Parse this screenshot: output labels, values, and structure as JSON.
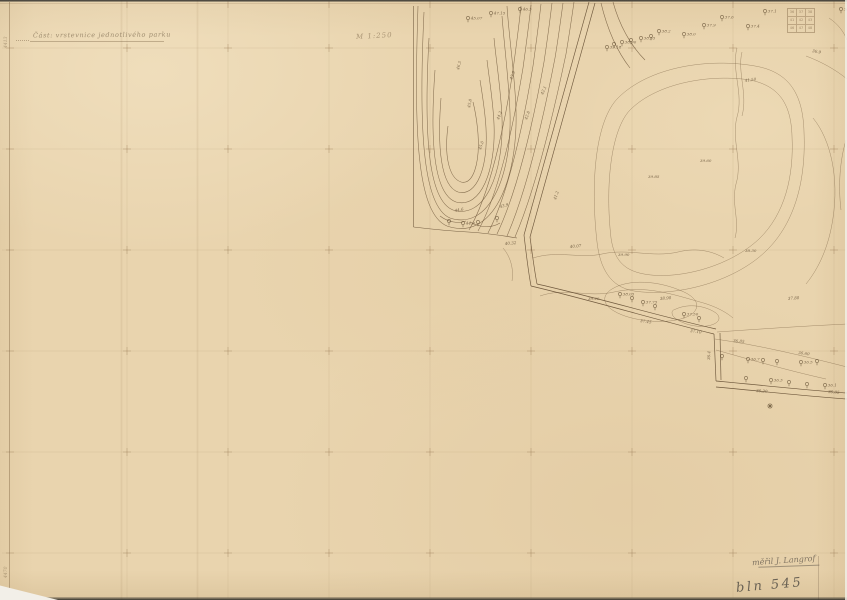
{
  "sheet": {
    "title": "Část: vrstevnice jednotlivého parku",
    "scale_note": "M 1:250",
    "surveyor_signature": "měřil J. Langrof",
    "sheet_number": "bln 545",
    "edge_mark_top": "4413",
    "edge_mark_bottom": "4470"
  },
  "stamp": {
    "rows": [
      [
        "36",
        "37",
        "38"
      ],
      [
        "41",
        "42",
        "43"
      ],
      [
        "46",
        "47",
        "48"
      ]
    ]
  },
  "colors": {
    "paper": "#e9d4ae",
    "ink": "#6c5437",
    "pencil": "#5d564b",
    "grid": "#a58a5f"
  },
  "grid": {
    "vxs": [
      127,
      228,
      329,
      430,
      531,
      632,
      733,
      834
    ],
    "hys": [
      48,
      149,
      250,
      351,
      452,
      553
    ]
  },
  "map": {
    "boundaries": [
      "M413.5,6 L413.5,227",
      "M413.5,227 C430,229 450,231 468,232 C485,233 505,236 517,238"
    ],
    "roads": [
      {
        "a": "M589,2 C566,85 543,165 524,235",
        "b": "M595,3 C572,86 549,167 530,237"
      },
      {
        "a": "M524,235 C526,252 528,270 531,286",
        "b": "M530,237 C532,252 534,268 537,284"
      },
      {
        "a": "M531,286 C590,300 650,318 714,334",
        "b": "M537,284 C595,297 655,315 716,329"
      },
      {
        "a": "M714,334 L716,381",
        "b": "M720,333 L721,380"
      },
      {
        "a": "M716,381 C760,385 805,390 847,393",
        "b": "M716,387 C760,391 805,396 847,399"
      }
    ],
    "contours": [
      "M448,126 C444,156 449,178 461,182 C473,185 480,164 478,134 C477,121 475,110 473,102",
      "M441,98 C437,148 441,186 458,192 C477,197 488,167 486,128 C485,110 482,93 480,80",
      "M435,70 C430,138 433,194 456,202 C481,209 496,170 494,124 C493,100 489,78 487,60",
      "M429,38 C424,128 427,200 453,210 C485,220 504,173 502,118 C501,90 496,60 494,38",
      "M424,12 C419,118 421,206 450,218 C489,231 512,176 510,113 C509,82 504,43 502,16",
      "M418,6 C414,128 416,213 447,226 C493,242 518,180 516,110 C515,76 509,38 507,6",
      "M469,230 C489,196 504,130 513,70 C516,48 519,25 521,6",
      "M478,231 C498,195 513,128 523,68 C526,46 529,24 531,5",
      "M488,233 C508,194 523,126 533,66 C536,44 539,22 541,4",
      "M497,234 C517,192 533,124 544,62 C547,42 550,20 552,3",
      "M507,236 C527,190 543,120 555,58 C558,40 561,18 563,3",
      "M515,237 C536,188 553,116 566,54 C569,36 572,16 574,2",
      "M601,3 C607,28 616,50 630,68",
      "M613,2 C619,24 630,45 645,60",
      "M440,216 C448,222 458,224 466,221",
      "M470,222 C480,228 492,228 500,223"
    ],
    "light": [
      "M597,242 C590,180 596,120 618,98 C650,66 710,58 755,66 C790,72 803,95 804,132 C806,178 796,222 766,251 C732,284 672,297 634,291 C610,287 600,268 597,242 Z",
      "M611,238 C605,185 611,130 630,110 C658,82 712,74 750,80 C780,86 791,105 792,136 C794,176 785,214 759,239 C728,268 676,280 644,274 C622,270 614,258 611,238 Z",
      "M737,48 C731,70 744,94 737,117 C731,140 743,161 736,184 C731,204 740,220 735,238",
      "M742,52 C737,72 748,94 742,116",
      "M533,258 C558,250 580,259 602,254 C628,248 652,258 678,252 C698,247 714,252 724,258",
      "M540,296 C565,287 588,298 614,292 C645,285 672,294 700,302 C715,306 726,312 733,318",
      "M806,56 C822,62 836,70 847,79",
      "M813,118 C831,140 839,178 833,218 C829,246 819,268 806,284",
      "M846,140 C840,160 838,185 841,210",
      "M829,18 C838,24 844,32 847,40",
      "M717,332 C760,329 804,326 847,324",
      "M715,339 C758,345 800,355 847,367",
      "M716,350 C748,359 786,370 826,379",
      "M612,289 C628,279 658,280 684,292 C699,299 701,309 689,316 C668,326 630,321 614,311 C602,304 602,295 612,289 Z",
      "M676,309 C689,303 706,306 716,313 C722,318 719,324 707,326 C693,328 678,322 673,316 C671,312 672,310 676,309 Z",
      "M503,248 C510,256 514,268 512,281"
    ],
    "trees": [
      {
        "x": 468,
        "y": 18,
        "l": "45.07"
      },
      {
        "x": 491,
        "y": 13,
        "l": "47.15"
      },
      {
        "x": 520,
        "y": 9,
        "l": "46.3"
      },
      {
        "x": 607,
        "y": 47,
        "l": "39.18"
      },
      {
        "x": 614,
        "y": 44,
        "l": ""
      },
      {
        "x": 622,
        "y": 42,
        "l": "38.90"
      },
      {
        "x": 631,
        "y": 40,
        "l": ""
      },
      {
        "x": 641,
        "y": 38,
        "l": "38.55"
      },
      {
        "x": 651,
        "y": 36,
        "l": ""
      },
      {
        "x": 659,
        "y": 31,
        "l": "38.2"
      },
      {
        "x": 684,
        "y": 34,
        "l": "38.0"
      },
      {
        "x": 704,
        "y": 25,
        "l": "37.9"
      },
      {
        "x": 722,
        "y": 17,
        "l": "37.6"
      },
      {
        "x": 748,
        "y": 26,
        "l": "37.4"
      },
      {
        "x": 765,
        "y": 11,
        "l": "37.1"
      },
      {
        "x": 841,
        "y": 9,
        "l": "36.8"
      },
      {
        "x": 620,
        "y": 294,
        "l": "38.05"
      },
      {
        "x": 632,
        "y": 298,
        "l": ""
      },
      {
        "x": 643,
        "y": 302,
        "l": "37.75"
      },
      {
        "x": 655,
        "y": 306,
        "l": ""
      },
      {
        "x": 684,
        "y": 314,
        "l": "37.50"
      },
      {
        "x": 699,
        "y": 318,
        "l": ""
      },
      {
        "x": 722,
        "y": 356,
        "l": ""
      },
      {
        "x": 748,
        "y": 359,
        "l": "36.7"
      },
      {
        "x": 763,
        "y": 360,
        "l": ""
      },
      {
        "x": 777,
        "y": 361,
        "l": ""
      },
      {
        "x": 801,
        "y": 362,
        "l": "36.5"
      },
      {
        "x": 817,
        "y": 361,
        "l": ""
      },
      {
        "x": 746,
        "y": 378,
        "l": ""
      },
      {
        "x": 771,
        "y": 380,
        "l": "36.3"
      },
      {
        "x": 789,
        "y": 382,
        "l": ""
      },
      {
        "x": 807,
        "y": 384,
        "l": ""
      },
      {
        "x": 825,
        "y": 385,
        "l": "36.1"
      },
      {
        "x": 449,
        "y": 221,
        "l": ""
      },
      {
        "x": 463,
        "y": 223,
        "l": "44.9"
      },
      {
        "x": 478,
        "y": 222,
        "l": ""
      },
      {
        "x": 497,
        "y": 218,
        "l": ""
      }
    ],
    "labels": [
      {
        "x": 459,
        "y": 70,
        "t": "46.5",
        "r": -75
      },
      {
        "x": 470,
        "y": 108,
        "t": "45.8",
        "r": -78
      },
      {
        "x": 481,
        "y": 150,
        "t": "45.0",
        "r": -72
      },
      {
        "x": 499,
        "y": 120,
        "t": "44.2",
        "r": -70
      },
      {
        "x": 512,
        "y": 80,
        "t": "43.5",
        "r": -68
      },
      {
        "x": 527,
        "y": 120,
        "t": "42.8",
        "r": -70
      },
      {
        "x": 543,
        "y": 95,
        "t": "42.1",
        "r": -66
      },
      {
        "x": 455,
        "y": 212,
        "t": "44.6",
        "r": -10
      },
      {
        "x": 500,
        "y": 208,
        "t": "43.9",
        "r": -15
      },
      {
        "x": 556,
        "y": 200,
        "t": "41.2",
        "r": -72
      },
      {
        "x": 505,
        "y": 245,
        "t": "40.32",
        "r": -5
      },
      {
        "x": 648,
        "y": 178,
        "t": "39.85",
        "r": 0
      },
      {
        "x": 745,
        "y": 82,
        "t": "41.50",
        "r": -8
      },
      {
        "x": 700,
        "y": 162,
        "t": "39.60",
        "r": 0
      },
      {
        "x": 570,
        "y": 248,
        "t": "40.07",
        "r": -5
      },
      {
        "x": 618,
        "y": 256,
        "t": "39.90",
        "r": 0
      },
      {
        "x": 660,
        "y": 300,
        "t": "38.90",
        "r": -5
      },
      {
        "x": 588,
        "y": 300,
        "t": "39.20",
        "r": 0
      },
      {
        "x": 745,
        "y": 252,
        "t": "38.30",
        "r": 0
      },
      {
        "x": 788,
        "y": 300,
        "t": "37.80",
        "r": -5
      },
      {
        "x": 640,
        "y": 322,
        "t": "37.45",
        "r": 8
      },
      {
        "x": 690,
        "y": 332,
        "t": "37.10",
        "r": 8
      },
      {
        "x": 733,
        "y": 342,
        "t": "36.85",
        "r": 5
      },
      {
        "x": 798,
        "y": 354,
        "t": "36.60",
        "r": 7
      },
      {
        "x": 756,
        "y": 392,
        "t": "36.20",
        "r": 4
      },
      {
        "x": 828,
        "y": 393,
        "t": "36.05",
        "r": 4
      },
      {
        "x": 710,
        "y": 360,
        "t": "36.4",
        "r": -88
      },
      {
        "x": 812,
        "y": 52,
        "t": "36.9",
        "r": 10
      }
    ],
    "marks": [
      {
        "type": "star",
        "x": 770,
        "y": 406
      }
    ]
  }
}
